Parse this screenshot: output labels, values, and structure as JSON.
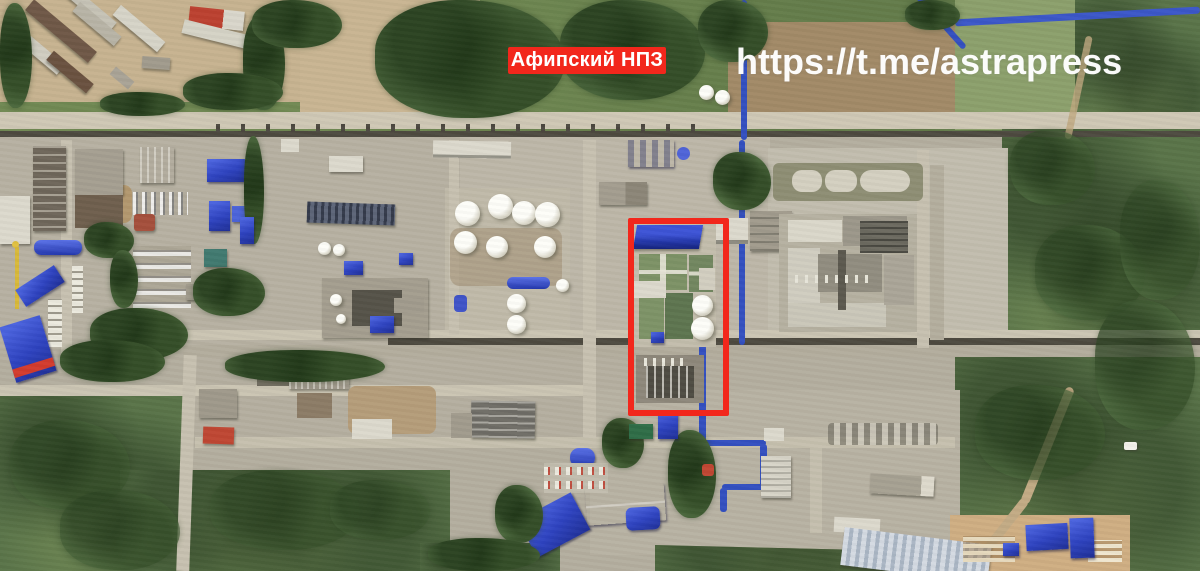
{
  "image": {
    "kind": "satellite-photo",
    "subject": "Афипский НПЗ (oil refinery), aerial/satellite view with annotation overlays"
  },
  "annotations": {
    "label": {
      "text": "Афипский НПЗ",
      "bg_color": "#f2271c",
      "text_color": "#ffffff",
      "css": "left:508px;top:47px;width:158px;height:27px;background:#f2271c;color:#ffffff"
    },
    "watermark": {
      "text": "https://t.me/astrapress",
      "color": "#ffffff",
      "css": "left:736px;top:41px;color:rgba(255,255,255,0.97)"
    },
    "highlight_box": {
      "color": "#f2271c",
      "css": "left:628px;top:218px;width:89px;height:186px;border:6px solid #f2271c"
    }
  },
  "palette": {
    "annotation_red": "#f2271c",
    "blue_roof": "#2e43c0",
    "vegetation_dark": "#4d6a3e",
    "vegetation_scrub": "#5a7449",
    "concrete": "#b7b1a2",
    "dirt": "#b59d7a",
    "road": "#cbc5b3",
    "pipe_rack": "#4e4a40",
    "tank_white": "#fdfdf8"
  }
}
